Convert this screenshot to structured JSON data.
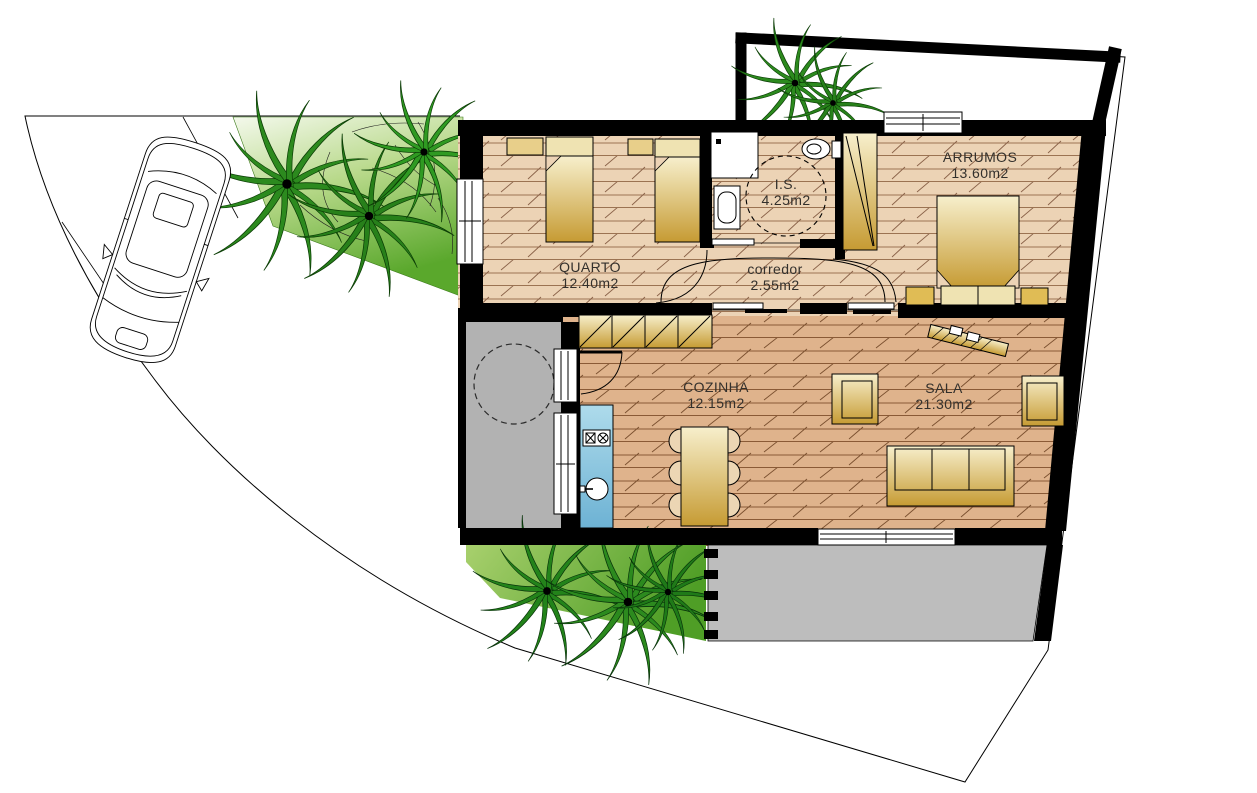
{
  "plan": {
    "type": "architectural-floor-plan",
    "rooms": [
      {
        "id": "quarto",
        "name": "QUARTO",
        "area": "12.40m2"
      },
      {
        "id": "is",
        "name": "I.S.",
        "area": "4.25m2"
      },
      {
        "id": "corredor",
        "name": "corredor",
        "area": "2.55m2"
      },
      {
        "id": "arrumos",
        "name": "ARRUMOS",
        "area": "13.60m2"
      },
      {
        "id": "cozinha",
        "name": "COZINHA",
        "area": "12.15m2"
      },
      {
        "id": "sala",
        "name": "SALA",
        "area": "21.30m2"
      }
    ],
    "colors": {
      "wall": "#000000",
      "floor_top_rooms": "#ecd3b5",
      "floor_living": "#dfb38c",
      "patio_gray": "#b2b2b2",
      "terrace_gray": "#bdbdbd",
      "kitchen_counter_blue": "#8cc7e0",
      "furniture_light": "#f7efcc",
      "furniture_dark": "#c69b33",
      "garden_green": "#5aa82c",
      "palm_green": "#2c8a1e"
    }
  }
}
